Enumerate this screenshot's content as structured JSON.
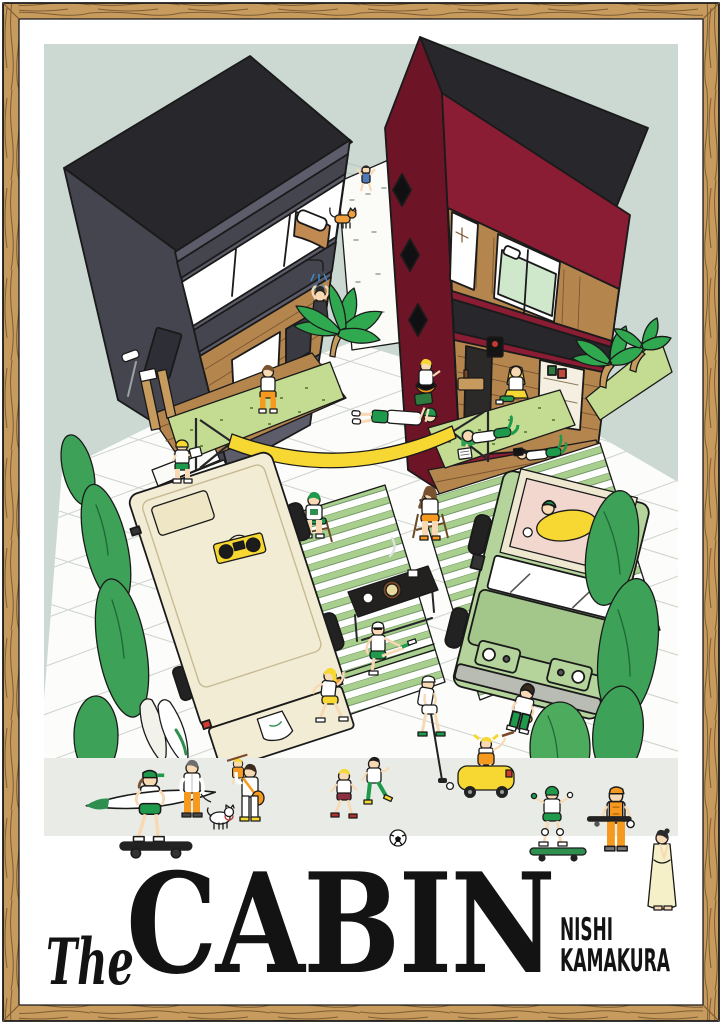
{
  "poster": {
    "title_script": "The",
    "title_main": "CABIN",
    "subtitle_line1": "NISHI",
    "subtitle_line2": "KAMAKURA"
  },
  "palette": {
    "bg": "#ccd9d2",
    "band": "#e9ece6",
    "ink": "#1a1a1a",
    "framewood": "#c79b5e",
    "framegrain": "#7d5d33",
    "roof": "#27272c",
    "gray": "#5c5c6a",
    "graydk": "#45454f",
    "red": "#8a1c33",
    "reddk": "#6d1426",
    "wood": "#b5854e",
    "wooddk": "#7a5630",
    "grass": "#c3dc92",
    "hedge": "#3da257",
    "hedgedk": "#1f6b38",
    "palm": "#2fa84f",
    "mat": "#a9cf8e",
    "van": "#f2ecd4",
    "jeep": "#b4d49c",
    "jeepdk": "#a3c78b",
    "skin": "#f7d9b4",
    "orange": "#f59a1e",
    "yellow": "#f7d832",
    "green": "#1f9a4d",
    "title": "#131313"
  },
  "scene": {
    "elements": [
      "wood-picture-frame",
      "white-matte",
      "sage-backdrop",
      "charcoal-cabin-with-black-roof",
      "maroon-cabin-with-black-roof",
      "outdoor-shower",
      "orange-cat",
      "palm-trees",
      "hedges",
      "yellow-hammock-reader",
      "wood-decks",
      "striped-green-mats",
      "cream-camper-van-with-boombox",
      "green-suv-with-rooftop-tent",
      "bbq-table",
      "camp-chairs",
      "soccer-kids",
      "golfer",
      "stretchers",
      "toy-car-girl",
      "kid-skateboarder",
      "surfboard-skater",
      "dog-walker",
      "parent-carrying-child",
      "worker-in-orange",
      "robe-woman"
    ]
  }
}
